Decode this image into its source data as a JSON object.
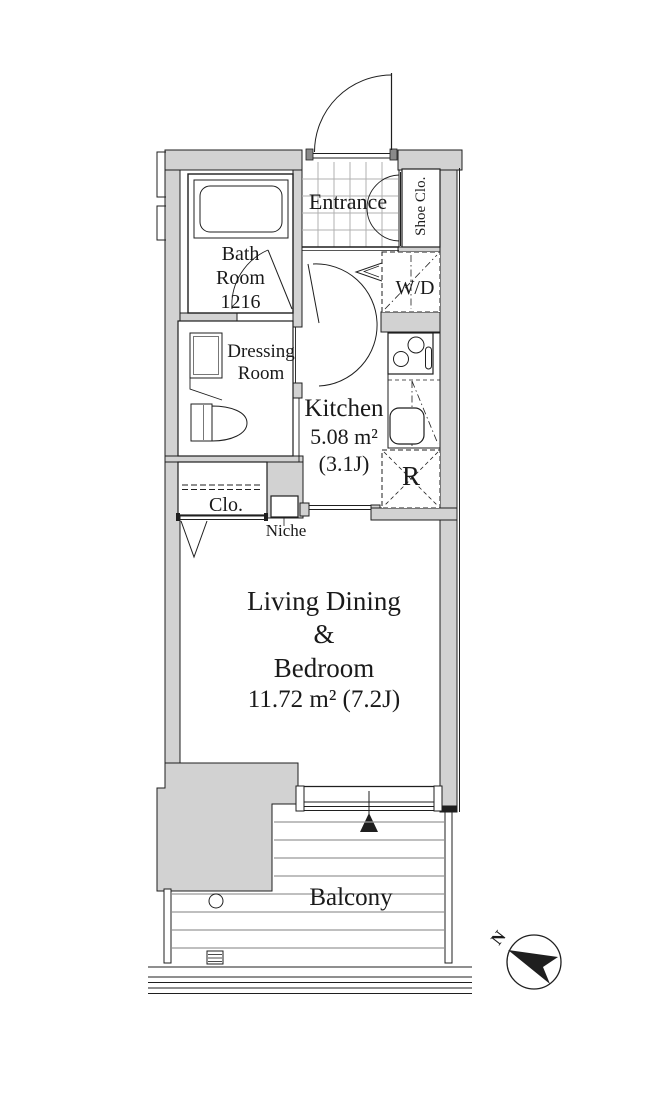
{
  "plan": {
    "title": "apartment-floor-plan",
    "rooms": {
      "entrance": {
        "label": "Entrance"
      },
      "shoe_closet": {
        "label": "Shoe Clo."
      },
      "bathroom": {
        "line1": "Bath",
        "line2": "Room",
        "line3": "1216"
      },
      "washer_dryer": {
        "label": "W/D"
      },
      "dressing_room": {
        "line1": "Dressing",
        "line2": "Room"
      },
      "kitchen": {
        "label": "Kitchen",
        "area_m2": "5.08 m²",
        "area_jo": "(3.1J)"
      },
      "refrigerator": {
        "label": "R"
      },
      "closet": {
        "label": "Clo."
      },
      "niche": {
        "label": "Niche"
      },
      "living": {
        "line1": "Living Dining",
        "line2": "&",
        "line3": "Bedroom",
        "line4": "11.72 m² (7.2J)"
      },
      "balcony": {
        "label": "Balcony"
      }
    },
    "compass": {
      "north_label": "N"
    },
    "colors": {
      "wall_fill": "#d2d2d2",
      "line": "#1f1f1f",
      "tile_grid": "#b0b0b0",
      "balcony_slat": "#999999"
    }
  }
}
